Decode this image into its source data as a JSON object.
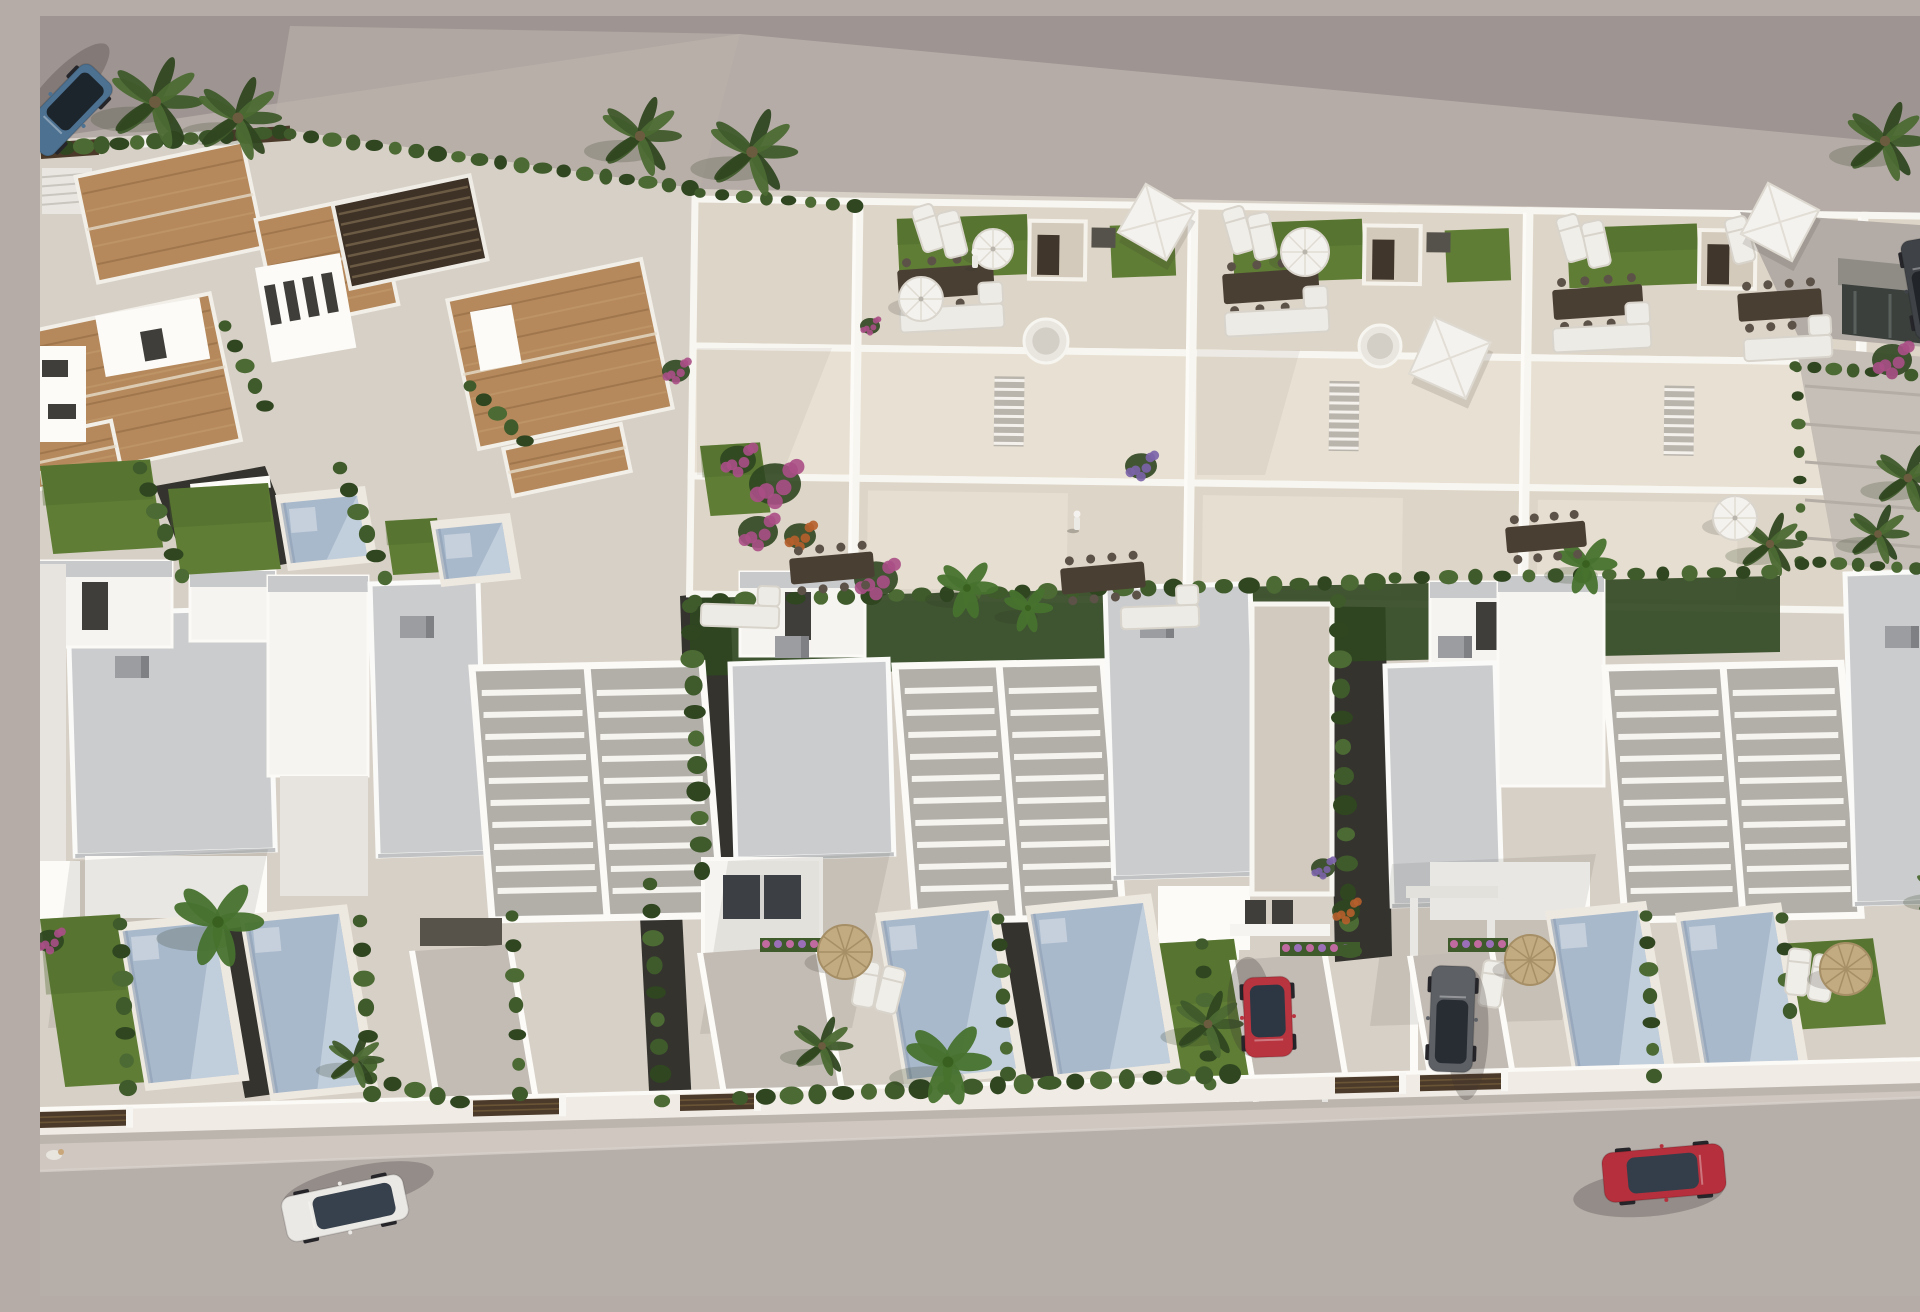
{
  "scene": {
    "title": "Aerial 3D architectural render of a white villa development with rooftop terraces, private pools, palm trees, terracotta-roof houses and cars on the street",
    "width": 1920,
    "height": 1280
  },
  "palette": {
    "vacant": "#b5aca7",
    "roadTop": "#9e9592",
    "road": "#b6aea9",
    "sidewalk": "#cfc7c0",
    "devBase": "#d7d0c6",
    "deck": "#ddd5c7",
    "deckSun": "#e8e1d3",
    "deckPale": "#d2cabe",
    "white": "#f6f4f0",
    "whiteBright": "#fcfbf8",
    "whiteShade": "#e7e4df",
    "grayTop": "#c8c9cb",
    "slab": "#cbccce",
    "slabShade": "#a9abae",
    "pergBed": "#b2afa9",
    "terracotta": "#b5895c",
    "terraDark": "#8f6841",
    "terraLight": "#c59d6e",
    "pergDark": "#3e3227",
    "woodGate": "#4b3a29",
    "lawn": "#5f7d35",
    "lawnDark": "#4a6629",
    "hedge": "#3f5a2b",
    "hedgeDark": "#2f4620",
    "hedgeLight": "#4c6a33",
    "banana": "#47722e",
    "gravel": "#34332e",
    "pool": "#a9b9cc",
    "poolSun": "#c6d1dd",
    "poolShade": "#8d9db4",
    "poolDeck": "#eee9e0",
    "magenta": "#aa4f86",
    "orangeF": "#b65f2c",
    "purpleF": "#7b63a8",
    "straw": "#c2ab80",
    "strawDark": "#a68f66",
    "umbrWhite": "#f4f2ee",
    "furnWood": "#4a3f33",
    "furnWhite": "#edebe5",
    "stone": "#d3cabb",
    "winDark": "#3f3e3a",
    "shadow": "#3c3731"
  },
  "topRoad": {
    "pts": "0,0 1920,0 1920,133 700,18 0,123"
  },
  "vacantWash": {
    "pts": "250,10 700,18 660,172 233,112"
  },
  "vacantShadows": [
    {
      "x": 1240,
      "y": 445,
      "rx": 230,
      "ry": 42
    },
    {
      "x": 1650,
      "y": 470,
      "rx": 200,
      "ry": 36
    },
    {
      "x": 980,
      "y": 398,
      "rx": 185,
      "ry": 36
    }
  ],
  "devBase": {
    "pts": "0,128 233,112 660,173 1700,195 1920,212 1920,1046 0,1097"
  },
  "gardenStrip": {
    "pts": "650,582 1740,560 1740,636 650,660"
  },
  "wall": {
    "pts": "0,1093 1920,1042 1920,1066 0,1119"
  },
  "sidewalk": {
    "pts": "0,1119 1920,1066 1920,1080 0,1155"
  },
  "roadBottom": {
    "pts": "0,1155 1920,1080 1920,1280 0,1280"
  },
  "gates": [
    [
      0,
      88
    ],
    [
      433,
      521
    ],
    [
      640,
      716
    ],
    [
      1295,
      1361
    ],
    [
      1380,
      1463
    ]
  ],
  "villaRoofs": [
    {
      "cx": 130,
      "cy": 196,
      "w": 170,
      "h": 108,
      "rot": -12
    },
    {
      "cx": 85,
      "cy": 372,
      "w": 205,
      "h": 150,
      "rot": -12
    },
    {
      "cx": 287,
      "cy": 246,
      "w": 122,
      "h": 112,
      "rot": -12
    },
    {
      "cx": 520,
      "cy": 338,
      "w": 198,
      "h": 152,
      "rot": -12
    },
    {
      "cx": 30,
      "cy": 440,
      "w": 95,
      "h": 52,
      "rot": -12
    },
    {
      "cx": 527,
      "cy": 444,
      "w": 120,
      "h": 48,
      "rot": -12
    }
  ],
  "villaPergola": {
    "cx": 370,
    "cy": 216,
    "w": 140,
    "h": 86,
    "rot": -12
  },
  "villaWalls": [
    {
      "x": 55,
      "y": 300,
      "w": 106,
      "h": 62,
      "rot": -10
    },
    {
      "x": 215,
      "y": 252,
      "w": 86,
      "h": 96,
      "rot": -10
    },
    {
      "x": 430,
      "y": 296,
      "w": 42,
      "h": 60,
      "rot": -10
    },
    {
      "x": 0,
      "y": 330,
      "w": 46,
      "h": 96,
      "rot": 0
    },
    {
      "x": 0,
      "y": 455,
      "w": 92,
      "h": 14,
      "rot": -6
    },
    {
      "x": 150,
      "y": 468,
      "w": 80,
      "h": 12,
      "rot": -6
    }
  ],
  "villaWindows": [
    {
      "x": 224,
      "y": 270,
      "w": 11,
      "h": 40,
      "rot": -10
    },
    {
      "x": 243,
      "y": 266,
      "w": 11,
      "h": 40,
      "rot": -10
    },
    {
      "x": 262,
      "y": 262,
      "w": 11,
      "h": 40,
      "rot": -10
    },
    {
      "x": 281,
      "y": 258,
      "w": 11,
      "h": 40,
      "rot": -10
    },
    {
      "x": 2,
      "y": 344,
      "w": 26,
      "h": 17,
      "rot": 0
    },
    {
      "x": 8,
      "y": 388,
      "w": 28,
      "h": 15,
      "rot": 0
    },
    {
      "x": 100,
      "y": 316,
      "w": 22,
      "h": 30,
      "rot": -10
    }
  ],
  "fenceSegs": [
    {
      "x": 0,
      "y": 127,
      "w": 58,
      "h": 16,
      "rot": -4,
      "dark": true
    },
    {
      "x": 188,
      "y": 114,
      "w": 62,
      "h": 15,
      "rot": -4,
      "dark": true
    },
    {
      "x": 96,
      "y": 120,
      "w": 78,
      "h": 12,
      "rot": -4,
      "dark": false
    }
  ],
  "stairsNW": {
    "x": 2,
    "y": 152,
    "w": 50,
    "h": 46
  },
  "townhouses": {
    "rot": 0.8,
    "units": [
      {
        "x0": 655,
        "w": 165,
        "partial": true
      },
      {
        "x0": 820,
        "w": 335
      },
      {
        "x0": 1155,
        "w": 335
      },
      {
        "x0": 1490,
        "w": 335
      },
      {
        "x0": 1825,
        "w": 95,
        "partial": true
      }
    ]
  },
  "clusters": [
    {
      "t": "slab",
      "x": 28,
      "y": 598,
      "w": 200,
      "h": 242
    },
    {
      "t": "box",
      "x": 0,
      "y": 545,
      "w": 132,
      "h": 86
    },
    {
      "t": "win",
      "x": 42,
      "y": 566,
      "w": 26,
      "h": 48
    },
    {
      "t": "box",
      "x": 150,
      "y": 555,
      "w": 85,
      "h": 70
    },
    {
      "t": "boxTall",
      "x": 228,
      "y": 560,
      "w": 100,
      "h": 200
    },
    {
      "t": "slab",
      "x": 330,
      "y": 568,
      "w": 108,
      "h": 272
    },
    {
      "t": "perg",
      "x": 432,
      "y": 652,
      "w": 230,
      "h": 252
    },
    {
      "t": "face",
      "x": 45,
      "y": 840,
      "w": 182,
      "h": 62
    },
    {
      "t": "face",
      "x": 240,
      "y": 760,
      "w": 88,
      "h": 120,
      "shade": true
    },
    {
      "t": "gdoor",
      "x": 380,
      "y": 902,
      "w": 82,
      "h": 28
    },
    {
      "t": "vent",
      "x": 75,
      "y": 640
    },
    {
      "t": "vent",
      "x": 360,
      "y": 600
    },
    {
      "t": "box",
      "x": 700,
      "y": 556,
      "w": 125,
      "h": 84
    },
    {
      "t": "win",
      "x": 745,
      "y": 576,
      "w": 26,
      "h": 48
    },
    {
      "t": "slab",
      "x": 690,
      "y": 648,
      "w": 158,
      "h": 195
    },
    {
      "t": "perg",
      "x": 855,
      "y": 650,
      "w": 208,
      "h": 255
    },
    {
      "t": "slab",
      "x": 1065,
      "y": 572,
      "w": 145,
      "h": 290
    },
    {
      "t": "face",
      "x": 1118,
      "y": 870,
      "w": 92,
      "h": 64
    },
    {
      "t": "winpair",
      "x": 1205,
      "y": 884,
      "w": 48,
      "h": 26
    },
    {
      "t": "terr",
      "x": 1212,
      "y": 588,
      "w": 80,
      "h": 290
    },
    {
      "t": "carport",
      "x": 663,
      "y": 843,
      "w": 118,
      "h": 96
    },
    {
      "t": "vent",
      "x": 735,
      "y": 620
    },
    {
      "t": "vent",
      "x": 1100,
      "y": 600
    },
    {
      "t": "box",
      "x": 1390,
      "y": 566,
      "w": 125,
      "h": 84
    },
    {
      "t": "win",
      "x": 1436,
      "y": 586,
      "w": 26,
      "h": 48
    },
    {
      "t": "slab",
      "x": 1345,
      "y": 650,
      "w": 110,
      "h": 240
    },
    {
      "t": "boxTall",
      "x": 1458,
      "y": 560,
      "w": 106,
      "h": 210
    },
    {
      "t": "perg",
      "x": 1565,
      "y": 652,
      "w": 236,
      "h": 252
    },
    {
      "t": "slab",
      "x": 1805,
      "y": 558,
      "w": 115,
      "h": 330
    },
    {
      "t": "face",
      "x": 1390,
      "y": 846,
      "w": 160,
      "h": 58
    },
    {
      "t": "vent",
      "x": 1398,
      "y": 620
    },
    {
      "t": "vent",
      "x": 1845,
      "y": 610
    },
    {
      "t": "face",
      "x": 0,
      "y": 548,
      "w": 26,
      "h": 300,
      "shade": true
    },
    {
      "t": "face",
      "x": 0,
      "y": 845,
      "w": 40,
      "h": 58
    }
  ],
  "redCarport": {
    "walls": [
      [
        1193,
        928,
        6,
        158
      ],
      [
        1282,
        928,
        6,
        158
      ]
    ],
    "lintel": [
      1190,
      908,
      100,
      12
    ]
  },
  "grayCarport": {
    "walls": [
      [
        1370,
        876,
        8,
        186
      ],
      [
        1447,
        876,
        8,
        186
      ]
    ],
    "lintel": [
      1366,
      870,
      92,
      12
    ]
  },
  "gravels": [
    {
      "pts": "640,580 690,575 700,860 650,866"
    },
    {
      "pts": "1288,575 1345,570 1352,940 1295,946"
    },
    {
      "pts": "598,862 640,858 652,1090 610,1094"
    },
    {
      "pts": "115,470 225,450 262,545 152,565"
    },
    {
      "pts": "175,915 207,910 235,1078 205,1082"
    },
    {
      "pts": "951,905 993,900 1020,1060 980,1064"
    }
  ],
  "pools": [
    {
      "x": 85,
      "y": 915,
      "w": 88,
      "h": 152
    },
    {
      "x": 207,
      "y": 907,
      "w": 92,
      "h": 170
    },
    {
      "x": 843,
      "y": 905,
      "w": 106,
      "h": 158
    },
    {
      "x": 993,
      "y": 898,
      "w": 110,
      "h": 160
    },
    {
      "x": 1513,
      "y": 903,
      "w": 85,
      "h": 158
    },
    {
      "x": 1643,
      "y": 905,
      "w": 90,
      "h": 150
    },
    {
      "x": 243,
      "y": 487,
      "w": 74,
      "h": 60
    },
    {
      "x": 398,
      "y": 513,
      "w": 64,
      "h": 50
    }
  ],
  "lawns": [
    {
      "x": 0,
      "y": 903,
      "w": 80,
      "h": 168
    },
    {
      "x": 1108,
      "y": 928,
      "w": 86,
      "h": 138
    },
    {
      "x": 1738,
      "y": 928,
      "w": 95,
      "h": 86
    },
    {
      "x": 0,
      "y": 450,
      "w": 110,
      "h": 88
    },
    {
      "x": 128,
      "y": 473,
      "w": 100,
      "h": 86
    },
    {
      "x": 345,
      "y": 505,
      "w": 52,
      "h": 54
    },
    {
      "x": 660,
      "y": 430,
      "w": 60,
      "h": 70
    }
  ],
  "driveways": [
    {
      "x": 375,
      "y": 935,
      "w": 92,
      "h": 158
    },
    {
      "x": 663,
      "y": 937,
      "w": 112,
      "h": 156
    },
    {
      "x": 1195,
      "y": 944,
      "w": 87,
      "h": 142
    },
    {
      "x": 1373,
      "y": 940,
      "w": 76,
      "h": 122
    }
  ],
  "hedgerows": [
    [
      8,
      133,
      240,
      116,
      14,
      9
    ],
    [
      250,
      118,
      650,
      172,
      20,
      8
    ],
    [
      660,
      177,
      815,
      190,
      8,
      7
    ],
    [
      100,
      452,
      142,
      560,
      6,
      9
    ],
    [
      300,
      452,
      345,
      562,
      6,
      9
    ],
    [
      430,
      370,
      485,
      425,
      5,
      8
    ],
    [
      185,
      310,
      225,
      390,
      5,
      8
    ],
    [
      650,
      590,
      662,
      855,
      11,
      10
    ],
    [
      1298,
      585,
      1310,
      935,
      13,
      10
    ],
    [
      610,
      868,
      622,
      1085,
      9,
      9
    ],
    [
      80,
      908,
      88,
      1072,
      7,
      9
    ],
    [
      320,
      905,
      332,
      1078,
      7,
      9
    ],
    [
      472,
      900,
      480,
      1078,
      7,
      8
    ],
    [
      958,
      903,
      968,
      1058,
      7,
      8
    ],
    [
      1162,
      928,
      1170,
      1068,
      6,
      8
    ],
    [
      1606,
      900,
      1614,
      1060,
      7,
      8
    ],
    [
      1742,
      902,
      1750,
      995,
      4,
      8
    ],
    [
      700,
      1082,
      1190,
      1058,
      20,
      10
    ],
    [
      330,
      1062,
      420,
      1086,
      5,
      9
    ],
    [
      1755,
      350,
      1910,
      362,
      9,
      7
    ],
    [
      1760,
      545,
      1915,
      555,
      9,
      7
    ],
    [
      1757,
      352,
      1762,
      548,
      8,
      6
    ],
    [
      655,
      585,
      1335,
      566,
      28,
      9
    ],
    [
      1355,
      562,
      1730,
      556,
      15,
      8
    ]
  ],
  "palms": [
    {
      "x": 115,
      "y": 86,
      "s": 46
    },
    {
      "x": 198,
      "y": 102,
      "s": 42
    },
    {
      "x": 600,
      "y": 120,
      "s": 40
    },
    {
      "x": 712,
      "y": 136,
      "s": 44
    },
    {
      "x": 1845,
      "y": 125,
      "s": 40
    },
    {
      "x": 1905,
      "y": 875,
      "s": 30
    },
    {
      "x": 178,
      "y": 906,
      "s": 44,
      "b": true
    },
    {
      "x": 315,
      "y": 1044,
      "s": 28
    },
    {
      "x": 782,
      "y": 1030,
      "s": 30
    },
    {
      "x": 908,
      "y": 1046,
      "s": 42,
      "b": true
    },
    {
      "x": 1168,
      "y": 1008,
      "s": 34
    },
    {
      "x": 1546,
      "y": 548,
      "s": 30,
      "b": true
    },
    {
      "x": 1730,
      "y": 528,
      "s": 32
    },
    {
      "x": 927,
      "y": 572,
      "s": 30,
      "b": true
    },
    {
      "x": 988,
      "y": 592,
      "s": 24,
      "b": true
    },
    {
      "x": 1868,
      "y": 462,
      "s": 34
    },
    {
      "x": 1838,
      "y": 518,
      "s": 30
    }
  ],
  "flowers": [
    {
      "x": 735,
      "y": 468,
      "s": 26,
      "k": "magenta"
    },
    {
      "x": 718,
      "y": 516,
      "s": 20,
      "k": "magenta"
    },
    {
      "x": 760,
      "y": 520,
      "s": 16,
      "k": "orange"
    },
    {
      "x": 836,
      "y": 563,
      "s": 22,
      "k": "magenta"
    },
    {
      "x": 1101,
      "y": 450,
      "s": 16,
      "k": "purple"
    },
    {
      "x": 698,
      "y": 444,
      "s": 18,
      "k": "magenta"
    },
    {
      "x": 1283,
      "y": 852,
      "s": 12,
      "k": "purple"
    },
    {
      "x": 1306,
      "y": 895,
      "s": 14,
      "k": "orange"
    },
    {
      "x": 10,
      "y": 925,
      "s": 14,
      "k": "magenta"
    },
    {
      "x": 1852,
      "y": 344,
      "s": 20,
      "k": "magenta"
    },
    {
      "x": 636,
      "y": 355,
      "s": 14,
      "k": "magenta"
    },
    {
      "x": 830,
      "y": 310,
      "s": 10,
      "k": "magenta"
    }
  ],
  "flowerRows": [
    {
      "x": 720,
      "y": 922,
      "w": 96
    },
    {
      "x": 1240,
      "y": 926,
      "w": 80
    },
    {
      "x": 1408,
      "y": 922,
      "w": 60
    }
  ],
  "umbrellasRound": [
    {
      "x": 881,
      "y": 283,
      "r": 22
    },
    {
      "x": 953,
      "y": 233,
      "r": 20
    },
    {
      "x": 1265,
      "y": 236,
      "r": 24
    },
    {
      "x": 1695,
      "y": 502,
      "r": 22
    }
  ],
  "umbrellasSquare": [
    {
      "x": 1116,
      "y": 206,
      "s": 56,
      "rot": 30
    },
    {
      "x": 1410,
      "y": 342,
      "s": 62,
      "rot": 24
    },
    {
      "x": 1740,
      "y": 206,
      "s": 58,
      "rot": 28
    }
  ],
  "umbrellasStraw": [
    {
      "x": 805,
      "y": 936,
      "r": 27
    },
    {
      "x": 1490,
      "y": 944,
      "r": 25
    },
    {
      "x": 1806,
      "y": 953,
      "r": 26
    }
  ],
  "loungers": [
    [
      888,
      212,
      -18
    ],
    [
      912,
      218,
      -14
    ],
    [
      1198,
      214,
      -16
    ],
    [
      1222,
      220,
      -12
    ],
    [
      1532,
      222,
      -16
    ],
    [
      1556,
      228,
      -12
    ],
    [
      1700,
      224,
      -14
    ],
    [
      826,
      968,
      10
    ],
    [
      850,
      974,
      14
    ],
    [
      1452,
      968,
      8
    ],
    [
      1758,
      956,
      6
    ],
    [
      1782,
      962,
      10
    ]
  ],
  "tablesRoof": [
    {
      "x": 906,
      "y": 266,
      "w": 96,
      "h": 30,
      "rot": -4
    },
    {
      "x": 1231,
      "y": 270,
      "w": 96,
      "h": 30,
      "rot": -4
    },
    {
      "x": 1558,
      "y": 286,
      "w": 90,
      "h": 30,
      "rot": -4
    },
    {
      "x": 1740,
      "y": 289,
      "w": 84,
      "h": 28,
      "rot": -4
    }
  ],
  "tablesGround": [
    {
      "x": 792,
      "y": 552,
      "w": 84,
      "h": 26,
      "rot": -5
    },
    {
      "x": 1063,
      "y": 562,
      "w": 84,
      "h": 26,
      "rot": -5
    },
    {
      "x": 1506,
      "y": 521,
      "w": 80,
      "h": 26,
      "rot": -5
    }
  ],
  "sofas": [
    {
      "x": 912,
      "y": 302,
      "w": 104,
      "h": 24,
      "rot": -3
    },
    {
      "x": 1237,
      "y": 306,
      "w": 104,
      "h": 24,
      "rot": -3
    },
    {
      "x": 1562,
      "y": 322,
      "w": 98,
      "h": 24,
      "rot": -3
    },
    {
      "x": 1748,
      "y": 332,
      "w": 88,
      "h": 22,
      "rot": -3
    },
    {
      "x": 700,
      "y": 600,
      "w": 78,
      "h": 22,
      "rot": 2
    },
    {
      "x": 1120,
      "y": 601,
      "w": 78,
      "h": 22,
      "rot": -2
    }
  ],
  "daybeds": [
    {
      "x": 1006,
      "y": 325,
      "r": 22
    },
    {
      "x": 1340,
      "y": 330,
      "r": 21
    }
  ],
  "stairsList": [
    {
      "x": 957,
      "y": 356,
      "w": 30,
      "h": 68
    },
    {
      "x": 1292,
      "y": 360,
      "w": 30,
      "h": 68
    },
    {
      "x": 1627,
      "y": 376,
      "w": 30,
      "h": 64
    }
  ],
  "persons": [
    {
      "x": 1037,
      "y": 507
    },
    {
      "x": 935,
      "y": 245
    }
  ],
  "dog": {
    "x": 14,
    "y": 1139
  },
  "cars": [
    {
      "name": "blue-suv",
      "x": 27,
      "y": 94,
      "angle": 134,
      "len": 98,
      "wid": 42,
      "body": "#4d7191",
      "glass": "#1c242c",
      "kind": "suv"
    },
    {
      "name": "white-hatchback",
      "x": 305,
      "y": 1192,
      "angle": 168,
      "len": 124,
      "wid": 46,
      "body": "#ebe9e5",
      "glass": "#37414d",
      "kind": "hatch"
    },
    {
      "name": "red-city-car",
      "x": 1228,
      "y": 1001,
      "angle": 88,
      "len": 80,
      "wid": 48,
      "body": "#b8343f",
      "glass": "#2d3743",
      "kind": "hatch"
    },
    {
      "name": "gray-estate-car",
      "x": 1412,
      "y": 1003,
      "angle": -88,
      "len": 106,
      "wid": 44,
      "body": "#5d6065",
      "glass": "#282d33",
      "kind": "suv"
    },
    {
      "name": "red-sedan",
      "x": 1624,
      "y": 1157,
      "angle": -5,
      "len": 122,
      "wid": 50,
      "body": "#b5303c",
      "glass": "#333e4a",
      "kind": "sedan"
    },
    {
      "name": "dark-parked-car",
      "x": 1888,
      "y": 272,
      "angle": -100,
      "len": 100,
      "wid": 40,
      "body": "#3f4347",
      "glass": "#212529",
      "kind": "suv"
    }
  ],
  "rightProp": {
    "pave": "1700,196 1920,212 1920,334 1758,320",
    "frame": "1798,242 1920,254 1920,281 1798,269",
    "facade": "1802,268 1920,280 1920,332 1802,318",
    "court": "1756,330 1920,344 1920,560 1796,548",
    "whiteEdge": [
      1894,
      300,
      26,
      262
    ]
  },
  "shadowPolys": [
    {
      "pts": "30,845 228,833 192,1004 8,1012",
      "o": 0.1
    },
    {
      "pts": "688,845 850,837 812,1012 660,1018",
      "o": 0.1
    },
    {
      "pts": "1352,848 1556,838 1522,1004 1330,1010",
      "o": 0.1
    },
    {
      "pts": "657,332 792,332 742,459 657,459",
      "o": 0.06
    },
    {
      "pts": "1157,334 1260,334 1225,459 1157,459",
      "o": 0.06
    },
    {
      "pts": "0,1119 1920,1066 1920,1074 0,1128",
      "o": 0.12
    }
  ]
}
